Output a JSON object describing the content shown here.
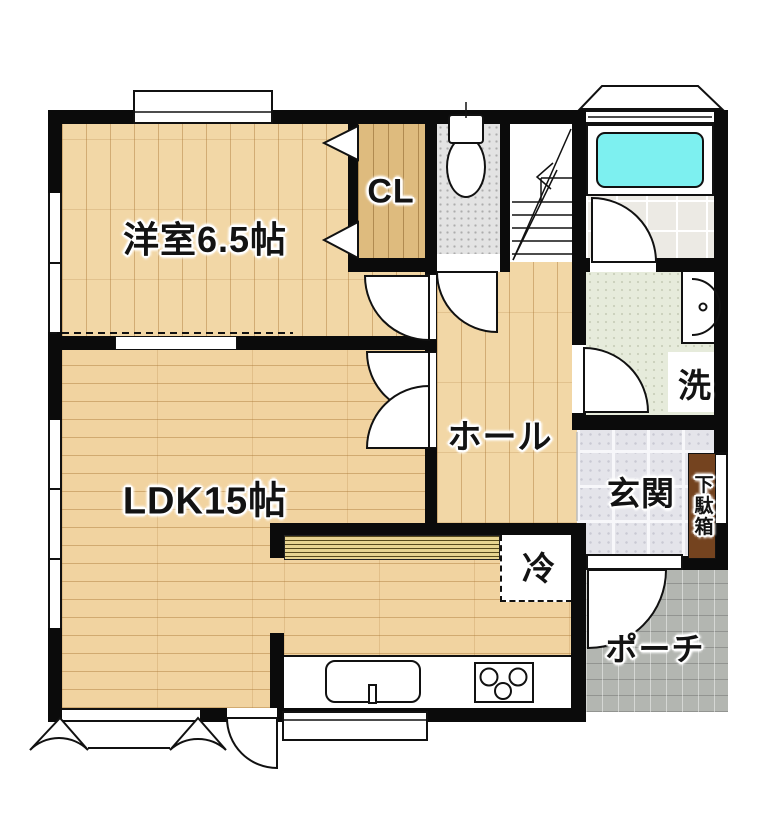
{
  "plan": {
    "type": "floor-plan",
    "labels": {
      "western_room": "洋室6.5帖",
      "closet": "CL",
      "hall": "ホール",
      "ldk": "LDK15帖",
      "entrance": "玄関",
      "shoe_cabinet": "下駄箱",
      "laundry": "洗",
      "fridge": "冷",
      "porch": "ポーチ"
    },
    "colors": {
      "wall": "#0b0b0b",
      "wood_floor": "#f2d7a6",
      "closet_floor": "#debb7e",
      "bathtub": "#7df0f0",
      "washroom_floor": "#e6ebdb",
      "toilet_floor": "#e3e3e3",
      "entrance_tile": "#e4e4ea",
      "porch_tile": "#b3b6b1",
      "kitchen_counter": "#e7d491",
      "shoe_cabinet": "#74431f"
    },
    "fixtures": [
      "bathtub",
      "toilet",
      "washbasin",
      "laundry-space",
      "refrigerator-space",
      "kitchen-sink",
      "stove",
      "staircase",
      "shoe-cabinet",
      "bay-window"
    ]
  }
}
